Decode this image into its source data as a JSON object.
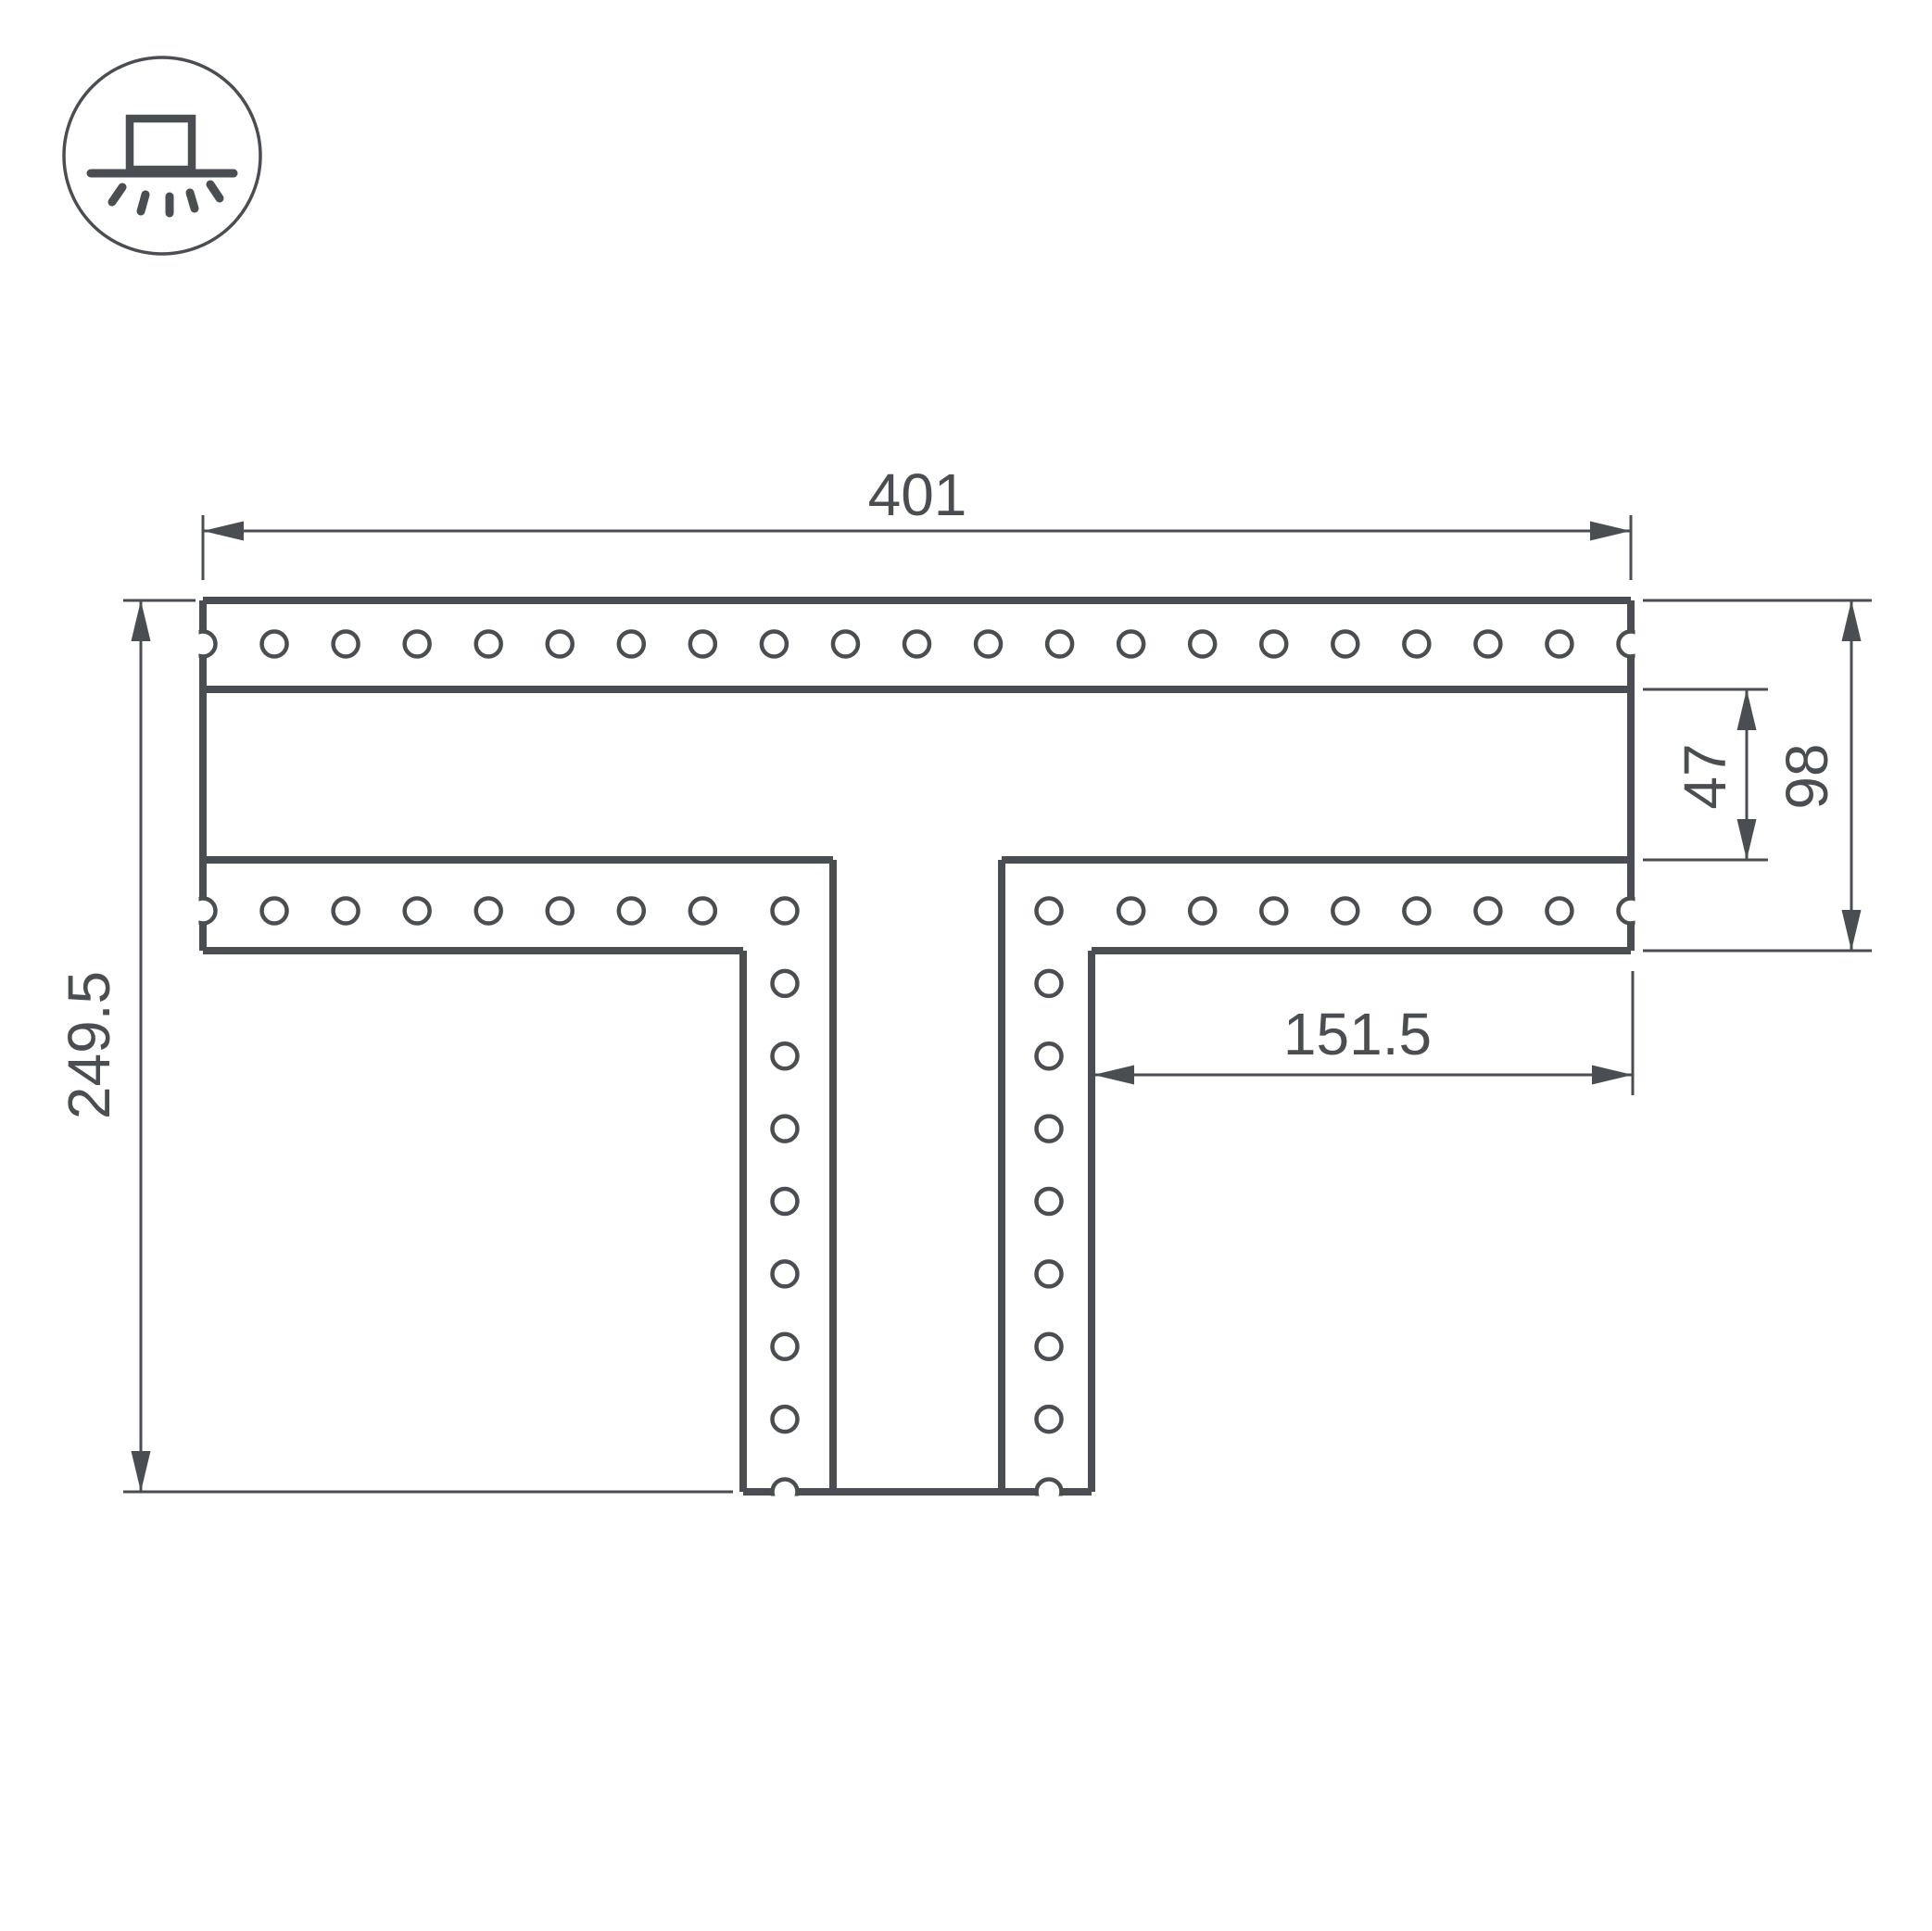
{
  "title": "T-shaped perforated connector technical drawing",
  "icon": {
    "type": "recessed-downlight"
  },
  "drawing": {
    "dim_width_total": "401",
    "dim_height_total": "249.5",
    "dim_slot_height": "47",
    "dim_bar_height": "98",
    "dim_right_offset": "151.5"
  },
  "colors": {
    "line": "#4a4e53",
    "background": "#ffffff"
  }
}
